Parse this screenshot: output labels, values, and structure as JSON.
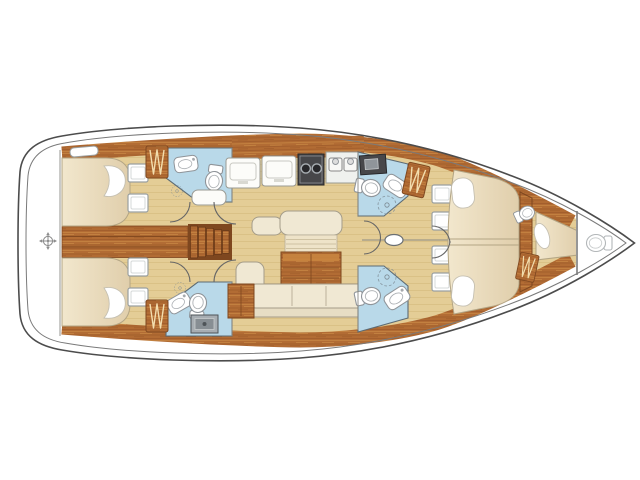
{
  "page": {
    "title": "Sailing yacht interior layout floor plan",
    "background": "#ffffff",
    "orientation": "bow-right, stern-left, top-down view"
  },
  "colors": {
    "hull_line": "#4c4c4c",
    "inner_deck_line": "#7a7a7a",
    "deck": "#ffffff",
    "wood_cabinetry": "#b26c34",
    "wood_dark": "#7e471f",
    "wood_highlight": "#c98a44",
    "cabin_sole_floor": "#e4cd96",
    "floor_grain": "#d5ba7d",
    "bathroom_blue": "#b9d9e9",
    "bathroom_border": "#5d6b74",
    "upholstery_cream": "#f0e8d3",
    "mattress_cream": "#f2e7cd",
    "mattress_shade": "#e0ceab",
    "fixture_white": "#ffffff",
    "fixture_border": "#8f9499",
    "stove_dark": "#47474a",
    "shower_tray_gray": "#a7adb2"
  },
  "areas": [
    {
      "id": "stern-deck",
      "label": "Stern deck / transom"
    },
    {
      "id": "aft-cabin-starboard",
      "label": "Aft double cabin (starboard)"
    },
    {
      "id": "aft-cabin-port",
      "label": "Aft double cabin (port)"
    },
    {
      "id": "aft-head-starboard",
      "label": "Aft head with washbasin and toilet (starboard)"
    },
    {
      "id": "aft-head-port",
      "label": "Aft head with shower tray, washbasin and toilet (port)"
    },
    {
      "id": "engine-compartment",
      "label": "Engine box between aft cabins"
    },
    {
      "id": "companionway-steps",
      "label": "Companionway steps"
    },
    {
      "id": "galley",
      "label": "Galley with counters, two-burner stove and double sink"
    },
    {
      "id": "salon",
      "label": "Salon with sofa, folding table and sideboard"
    },
    {
      "id": "forward-head-starboard",
      "label": "Forward head (starboard)"
    },
    {
      "id": "forward-head-port",
      "label": "Forward head (port)"
    },
    {
      "id": "forward-cabin",
      "label": "Forward double cabin with island berth"
    },
    {
      "id": "crew-cabin",
      "label": "Bow crew cabin with single berth"
    },
    {
      "id": "bow-head",
      "label": "Bow head at forepeak"
    }
  ],
  "fixtures": [
    {
      "id": "toilet-icon",
      "count": 6
    },
    {
      "id": "sink-icon",
      "count": 4
    },
    {
      "id": "stove-icon",
      "count": 1
    },
    {
      "id": "double-sink-icon",
      "count": 1
    },
    {
      "id": "shower-icon",
      "count": 4
    },
    {
      "id": "shower-tray-icon",
      "count": 1
    },
    {
      "id": "hanging-locker-icon",
      "count": 4
    },
    {
      "id": "locker-hatch-square",
      "count": 8
    },
    {
      "id": "deck-hatch",
      "count": 1
    },
    {
      "id": "mast-icon",
      "count": 1
    },
    {
      "id": "compass-icon",
      "count": 1
    },
    {
      "id": "bed-pillow",
      "count": 5
    }
  ]
}
